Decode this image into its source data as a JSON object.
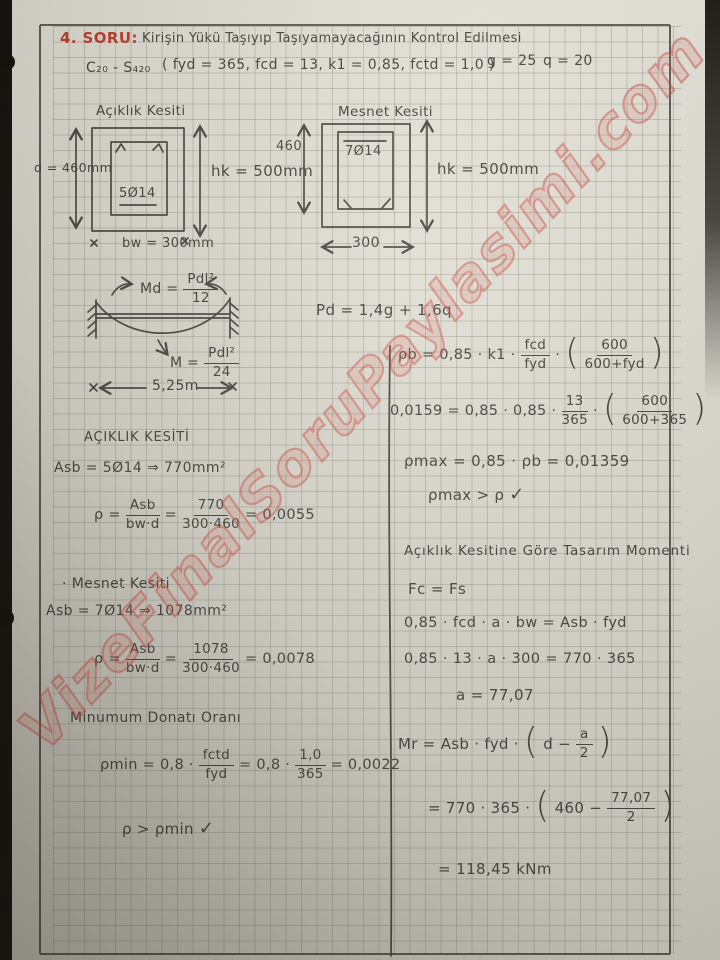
{
  "colors": {
    "accent_red": "#bd3a2a",
    "ink": "#45423c",
    "watermark_red": "#d45c52",
    "paper": "#dddbd0"
  },
  "glyphs": {
    "lparen": "(",
    "rparen": ")",
    "times": "·",
    "check": "✓"
  },
  "watermark": "VizeFinalSoruPaylasimi.com",
  "header": {
    "number": "4. SORU:",
    "title": "Kirişin Yükü Taşıyıp Taşıyamayacağının Kontrol Edilmesi",
    "materials": "C₂₀ - S₄₂₀",
    "parameters": "( fyd = 365,  fcd = 13,  k1 = 0,85,  fctd = 1,0 )",
    "dead_load": "g = 25",
    "live_load": "q = 20"
  },
  "span_section": {
    "title": "Açıklık Kesiti",
    "bars": "5Ø14",
    "depth": "d = 460mm",
    "height": "hk = 500mm",
    "width": "bw = 300mm"
  },
  "support_section": {
    "title": "Mesnet Kesiti",
    "bars": "7Ø14",
    "depth": "460",
    "height": "hk = 500mm",
    "width": "300"
  },
  "beam": {
    "support_moment_lhs": "Md =",
    "support_moment_num": "Pdl²",
    "support_moment_den": "12",
    "span_moment_lhs": "M =",
    "span_moment_num": "Pdl²",
    "span_moment_den": "24",
    "span_length": "5,25m",
    "design_load": "Pd = 1,4g + 1,6q"
  },
  "left_column": {
    "span_heading": "AÇIKLIK KESİTİ",
    "span_as": "Asb = 5Ø14 ⇒ 770mm²",
    "span_rho": {
      "lhs": "ρ =",
      "f1_num": "Asb",
      "f1_den": "bw·d",
      "eq": "=",
      "f2_num": "770",
      "f2_den": "300·460",
      "rhs": "= 0,0055"
    },
    "support_heading": "· Mesnet Kesiti",
    "support_as": "Asb = 7Ø14 ⇒ 1078mm²",
    "support_rho": {
      "lhs": "ρ =",
      "f1_num": "Asb",
      "f1_den": "bw·d",
      "eq": "=",
      "f2_num": "1078",
      "f2_den": "300·460",
      "rhs": "= 0,0078"
    },
    "min_heading": "Minumum Donatı Oranı",
    "rho_min": {
      "lhs": "ρmin = 0,8 ·",
      "f1_num": "fctd",
      "f1_den": "fyd",
      "mid": "= 0,8 ·",
      "f2_num": "1,0",
      "f2_den": "365",
      "rhs": "= 0,0022"
    },
    "min_check": "ρ > ρmin"
  },
  "right_column": {
    "rho_b": {
      "lhs": "ρb = 0,85 · k1 ·",
      "f1_num": "fcd",
      "f1_den": "fyd",
      "dot": "·",
      "f2_num": "600",
      "f2_den": "600+fyd"
    },
    "rho_b_num": {
      "lhs": "0,0159 = 0,85 · 0,85 ·",
      "f1_num": "13",
      "f1_den": "365",
      "dot": "·",
      "f2_num": "600",
      "f2_den": "600+365"
    },
    "rho_max": "ρmax = 0,85 · ρb = 0,01359",
    "rho_check": "ρmax > ρ",
    "design_heading": "Açıklık Kesitine Göre Tasarım Momenti",
    "equilibrium": "Fc = Fs",
    "stress_block_eq": "0,85 · fcd · a · bw = Asb · fyd",
    "stress_block_num": "0,85 · 13 · a · 300 = 770 · 365",
    "a_result": "a = 77,07",
    "mr": {
      "lhs": "Mr = Asb · fyd ·",
      "inner": "d −",
      "f_num": "a",
      "f_den": "2"
    },
    "mr_num": {
      "lhs": "= 770 · 365 ·",
      "inner": "460 −",
      "f_num": "77,07",
      "f_den": "2"
    },
    "mr_result": "= 118,45 kNm"
  }
}
